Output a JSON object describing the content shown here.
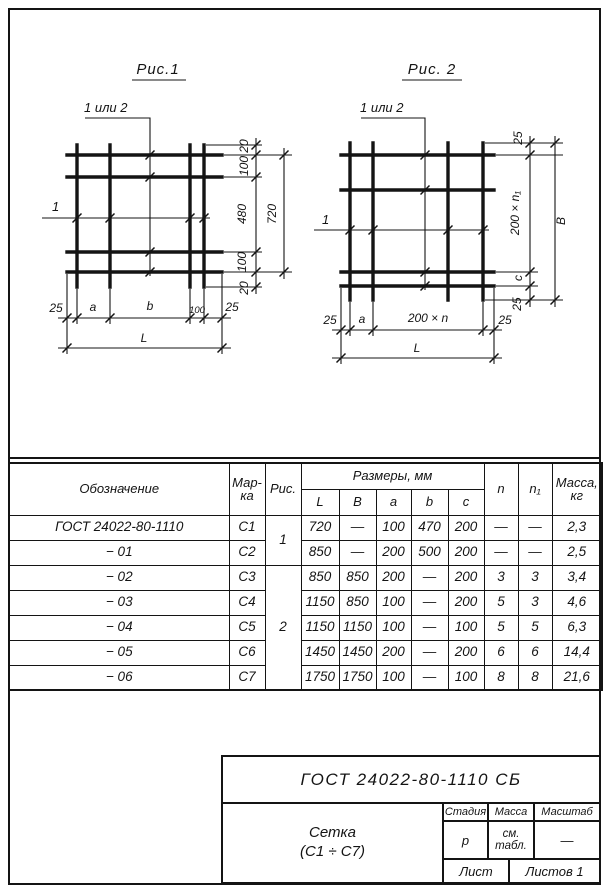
{
  "colors": {
    "ink": "#141414",
    "paper": "#ffffff"
  },
  "fig1": {
    "title": "Рис.1",
    "leader_label": "1 или 2",
    "left_label": "1",
    "dim_overhang_top": "20",
    "dim_top_pitch": "100",
    "dim_mid": "480",
    "dim_bottom_pitch": "100",
    "dim_overhang_bottom": "20",
    "dim_height_total": "720",
    "dim_left_overhang": "25",
    "dim_a": "a",
    "dim_b": "b",
    "dim_100": "100",
    "dim_right_overhang": "25",
    "dim_length": "L"
  },
  "fig2": {
    "title": "Рис. 2",
    "leader_label": "1 или 2",
    "left_label": "1",
    "dim_overhang_top": "25",
    "dim_pitch_v": "200 × n₁",
    "dim_c": "c",
    "dim_overhang_bottom": "25",
    "dim_height_total": "B",
    "dim_left_overhang": "25",
    "dim_a": "a",
    "dim_pitch_h": "200 × n",
    "dim_right_overhang": "25",
    "dim_length": "L"
  },
  "table": {
    "header": {
      "designation": "Обозначение",
      "mark": "Мар-\nка",
      "fig": "Рис.",
      "sizes": "Размеры, мм",
      "L": "L",
      "B": "B",
      "a": "a",
      "b": "b",
      "c": "c",
      "n": "n",
      "n1": "n₁",
      "mass": "Масса,\nкг"
    },
    "fig_group_1": "1",
    "fig_group_2": "2",
    "rows": [
      {
        "designation": "ГОСТ 24022-80-1110",
        "mark": "С1",
        "L": "720",
        "B": "—",
        "a": "100",
        "b": "470",
        "c": "200",
        "n": "—",
        "n1": "—",
        "mass": "2,3"
      },
      {
        "designation": "− 01",
        "mark": "С2",
        "L": "850",
        "B": "—",
        "a": "200",
        "b": "500",
        "c": "200",
        "n": "—",
        "n1": "—",
        "mass": "2,5"
      },
      {
        "designation": "− 02",
        "mark": "С3",
        "L": "850",
        "B": "850",
        "a": "200",
        "b": "—",
        "c": "200",
        "n": "3",
        "n1": "3",
        "mass": "3,4"
      },
      {
        "designation": "− 03",
        "mark": "С4",
        "L": "1150",
        "B": "850",
        "a": "100",
        "b": "—",
        "c": "200",
        "n": "5",
        "n1": "3",
        "mass": "4,6"
      },
      {
        "designation": "− 04",
        "mark": "С5",
        "L": "1150",
        "B": "1150",
        "a": "100",
        "b": "—",
        "c": "100",
        "n": "5",
        "n1": "5",
        "mass": "6,3"
      },
      {
        "designation": "− 05",
        "mark": "С6",
        "L": "1450",
        "B": "1450",
        "a": "200",
        "b": "—",
        "c": "200",
        "n": "6",
        "n1": "6",
        "mass": "14,4"
      },
      {
        "designation": "− 06",
        "mark": "С7",
        "L": "1750",
        "B": "1750",
        "a": "100",
        "b": "—",
        "c": "100",
        "n": "8",
        "n1": "8",
        "mass": "21,6"
      }
    ]
  },
  "title_block": {
    "doc": "ГОСТ 24022-80-1110 СБ",
    "name_line1": "Сетка",
    "name_line2": "(С1 ÷ С7)",
    "stage_label": "Стадия",
    "mass_label": "Масса",
    "scale_label": "Масштаб",
    "stage_value": "р",
    "mass_value": "см.\nтабл.",
    "scale_value": "—",
    "sheet_label": "Лист",
    "sheets_label": "Листов 1"
  }
}
